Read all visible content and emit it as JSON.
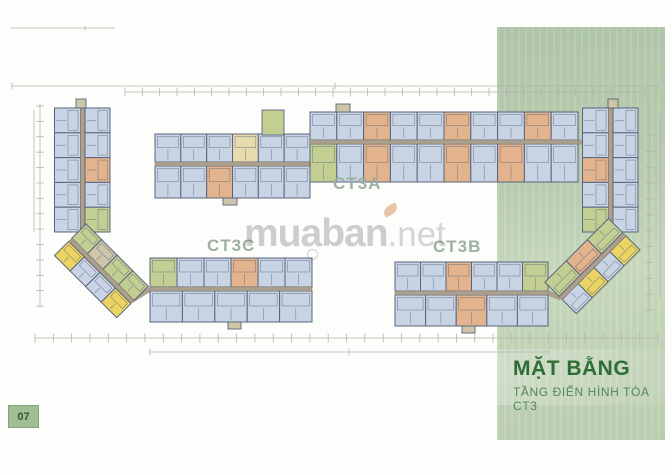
{
  "page": {
    "number": "07"
  },
  "panel": {
    "title": "MẶT BẰNG",
    "subtitle": "TẦNG ĐIỂN HÌNH TÒA CT3",
    "title_color": "#2e6d35",
    "subtitle_color": "#53875b",
    "bg_top": "#b2c8ac",
    "bg_bottom": "#c9dabe"
  },
  "watermark": {
    "text_main": "muaban",
    "text_suffix": ".net"
  },
  "plan": {
    "stroke": "#56647e",
    "corridor_color": "#ab9f8d",
    "corridor_edge": "#8a8174",
    "dim_color": "#b5b2ae",
    "label_color": "#9db0a1",
    "palette": {
      "b": "#c8d3e3",
      "o": "#e3b38d",
      "g": "#c3cf92",
      "y": "#ecd463",
      "c": "#e8dcae",
      "t": "#cfc5a8"
    },
    "labels": [
      {
        "text": "CT3A",
        "x": 333,
        "y": 189
      },
      {
        "text": "CT3C",
        "x": 207,
        "y": 251
      },
      {
        "text": "CT3B",
        "x": 433,
        "y": 252
      }
    ],
    "wings": [
      {
        "name": "tower-left",
        "x": 110,
        "y": 108,
        "rot": 90,
        "len": 124,
        "corridor": {
          "off": 25.5,
          "d": 4
        },
        "rows": [
          {
            "off": 0,
            "d": 25,
            "units": [
              "b",
              "b",
              "o",
              "b",
              "g"
            ]
          },
          {
            "off": 29.5,
            "d": 26,
            "units": [
              "b",
              "b",
              "b",
              "b",
              "b"
            ]
          }
        ]
      },
      {
        "name": "tower-right",
        "x": 638,
        "y": 108,
        "rot": 90,
        "len": 124,
        "corridor": {
          "off": 25.5,
          "d": 4
        },
        "rows": [
          {
            "off": 0,
            "d": 25,
            "units": [
              "b",
              "b",
              "b",
              "b",
              "b"
            ]
          },
          {
            "off": 29.5,
            "d": 26,
            "units": [
              "b",
              "b",
              "o",
              "b",
              "g"
            ]
          }
        ]
      },
      {
        "name": "ct3a-left",
        "x": 155,
        "y": 134,
        "rot": 0,
        "len": 155,
        "corridor": {
          "off": 28,
          "d": 4
        },
        "rows": [
          {
            "off": 0,
            "d": 28,
            "units": [
              "b",
              "b",
              "b",
              "c",
              "b",
              "b"
            ]
          },
          {
            "off": 32,
            "d": 32,
            "units": [
              "b",
              "b",
              "o",
              "b",
              "b",
              "b"
            ]
          }
        ]
      },
      {
        "name": "ct3a-right",
        "x": 310,
        "y": 112,
        "rot": 0,
        "len": 268,
        "corridor": {
          "off": 28,
          "d": 4
        },
        "rows": [
          {
            "off": 0,
            "d": 28,
            "units": [
              "b",
              "b",
              "o",
              "b",
              "b",
              "o",
              "b",
              "b",
              "o",
              "b"
            ]
          },
          {
            "off": 32,
            "d": 38,
            "units": [
              "g",
              "b",
              "o",
              "b",
              "b",
              "o",
              "b",
              "o",
              "b",
              "b"
            ]
          }
        ]
      },
      {
        "name": "ct3c",
        "x": 150,
        "y": 258,
        "rot": 0,
        "len": 162,
        "corridor": {
          "off": 29,
          "d": 4
        },
        "rows": [
          {
            "off": 0,
            "d": 29,
            "units": [
              "g",
              "b",
              "b",
              "o",
              "b",
              "b"
            ]
          },
          {
            "off": 33,
            "d": 31,
            "units": [
              "b",
              "b",
              "b",
              "b",
              "b"
            ]
          }
        ]
      },
      {
        "name": "ct3b",
        "x": 395,
        "y": 262,
        "rot": 0,
        "len": 153,
        "corridor": {
          "off": 29,
          "d": 4
        },
        "rows": [
          {
            "off": 0,
            "d": 29,
            "units": [
              "b",
              "b",
              "o",
              "b",
              "b",
              "g"
            ]
          },
          {
            "off": 33,
            "d": 31,
            "units": [
              "b",
              "b",
              "o",
              "b",
              "b"
            ]
          }
        ]
      },
      {
        "name": "diag-left",
        "x": 86,
        "y": 224,
        "rot": 45,
        "len": 88,
        "corridor": {
          "off": 20,
          "d": 4
        },
        "rows": [
          {
            "off": 0,
            "d": 20,
            "units": [
              "g",
              "t",
              "g",
              "g"
            ]
          },
          {
            "off": 24.5,
            "d": 20,
            "units": [
              "y",
              "b",
              "b",
              "y"
            ]
          }
        ]
      },
      {
        "name": "diag-right",
        "x": 640,
        "y": 250,
        "rot": 135,
        "len": 90,
        "corridor": {
          "off": 20,
          "d": 4
        },
        "rows": [
          {
            "off": 0,
            "d": 20,
            "units": [
              "y",
              "b",
              "y",
              "b"
            ]
          },
          {
            "off": 24.5,
            "d": 20,
            "units": [
              "g",
              "o",
              "g"
            ]
          }
        ]
      }
    ],
    "extras": [
      {
        "x": 76,
        "y": 99,
        "w": 10,
        "h": 9,
        "f": "t"
      },
      {
        "x": 608,
        "y": 99,
        "w": 10,
        "h": 9,
        "f": "t"
      },
      {
        "x": 336,
        "y": 104,
        "w": 14,
        "h": 8,
        "f": "t"
      },
      {
        "x": 223,
        "y": 198,
        "w": 14,
        "h": 7,
        "f": "t"
      },
      {
        "x": 262,
        "y": 110,
        "w": 22,
        "h": 25,
        "f": "g"
      },
      {
        "x": 228,
        "y": 322,
        "w": 13,
        "h": 7,
        "f": "t"
      },
      {
        "x": 462,
        "y": 326,
        "w": 13,
        "h": 7,
        "f": "t"
      }
    ],
    "corridors": [
      [
        310,
        142,
        310,
        164
      ],
      [
        576,
        142,
        585,
        142
      ],
      [
        83,
        230,
        72,
        241
      ],
      [
        131,
        301,
        150,
        289
      ],
      [
        548,
        293,
        561,
        298
      ],
      [
        610,
        230,
        624,
        236
      ]
    ],
    "dims": {
      "lines": [
        [
          12,
          86,
          658,
          86
        ],
        [
          125,
          92,
          645,
          92
        ],
        [
          10,
          28,
          115,
          28
        ],
        [
          85,
          26,
          85,
          31
        ],
        [
          35,
          338,
          658,
          338
        ],
        [
          150,
          352,
          548,
          352
        ],
        [
          40,
          104,
          40,
          308
        ],
        [
          34,
          110,
          34,
          232
        ],
        [
          649,
          102,
          649,
          312
        ],
        [
          660,
          110,
          660,
          298
        ]
      ],
      "ticks": [
        {
          "a": [
            125,
            92
          ],
          "b": [
            645,
            92
          ],
          "n": 30,
          "len": 9
        },
        {
          "a": [
            12,
            86
          ],
          "b": [
            658,
            86
          ],
          "n": 2,
          "len": 7
        },
        {
          "a": [
            40,
            106
          ],
          "b": [
            40,
            306
          ],
          "n": 13,
          "len": 8
        },
        {
          "a": [
            649,
            104
          ],
          "b": [
            649,
            310
          ],
          "n": 13,
          "len": 8
        },
        {
          "a": [
            35,
            338
          ],
          "b": [
            658,
            338
          ],
          "n": 34,
          "len": 9
        },
        {
          "a": [
            150,
            352
          ],
          "b": [
            548,
            352
          ],
          "n": 2,
          "len": 7
        }
      ]
    }
  }
}
